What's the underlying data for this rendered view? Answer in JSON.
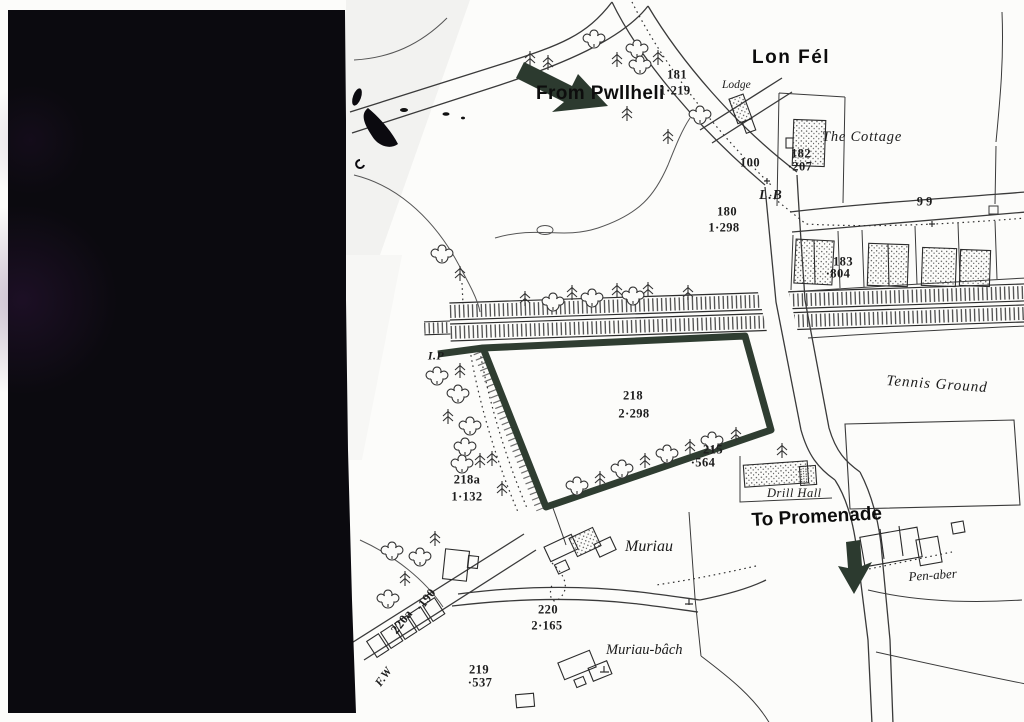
{
  "map": {
    "annotations": {
      "from_pwllheli": "From Pwllheli",
      "to_promenade": "To Promenade"
    },
    "roads": {
      "lon_fel": "Lon Fél"
    },
    "places": {
      "lodge": "Lodge",
      "cottage": "The Cottage",
      "tennis": "Tennis Ground",
      "drill_hall": "Drill Hall",
      "pen_aber": "Pen-aber",
      "muriau": "Muriau",
      "muriau_bach": "Muriau-bâch"
    },
    "abbrev": {
      "lb": "L.B",
      "ip": "I.P",
      "fw": "F.W"
    },
    "parcels": {
      "p181": {
        "n": "181",
        "a": "1·219"
      },
      "p180": {
        "n": "180",
        "a": "1·298"
      },
      "p182": {
        "n": "182",
        "a": "·207"
      },
      "p183": {
        "n": "183",
        "a": "·804"
      },
      "p218": {
        "n": "218",
        "a": "2·298"
      },
      "p215": {
        "n": "215",
        "a": "·564"
      },
      "p218a": {
        "n": "218a",
        "a": "1·132"
      },
      "p220": {
        "n": "220",
        "a": "2·165"
      },
      "p219": {
        "n": "219",
        "a": "·537"
      },
      "p220a": {
        "n": "220a",
        "a": "·190"
      }
    },
    "spots": {
      "s100": "100",
      "s99": "99"
    },
    "colors": {
      "ink": "#3a3a3a",
      "scan_black": "#0b0a0f",
      "scan_purple": "#4a1d5e",
      "plot_boundary": "#2f3d31",
      "arrow": "#2c3a2f",
      "paper": "#fcfcfa"
    }
  }
}
